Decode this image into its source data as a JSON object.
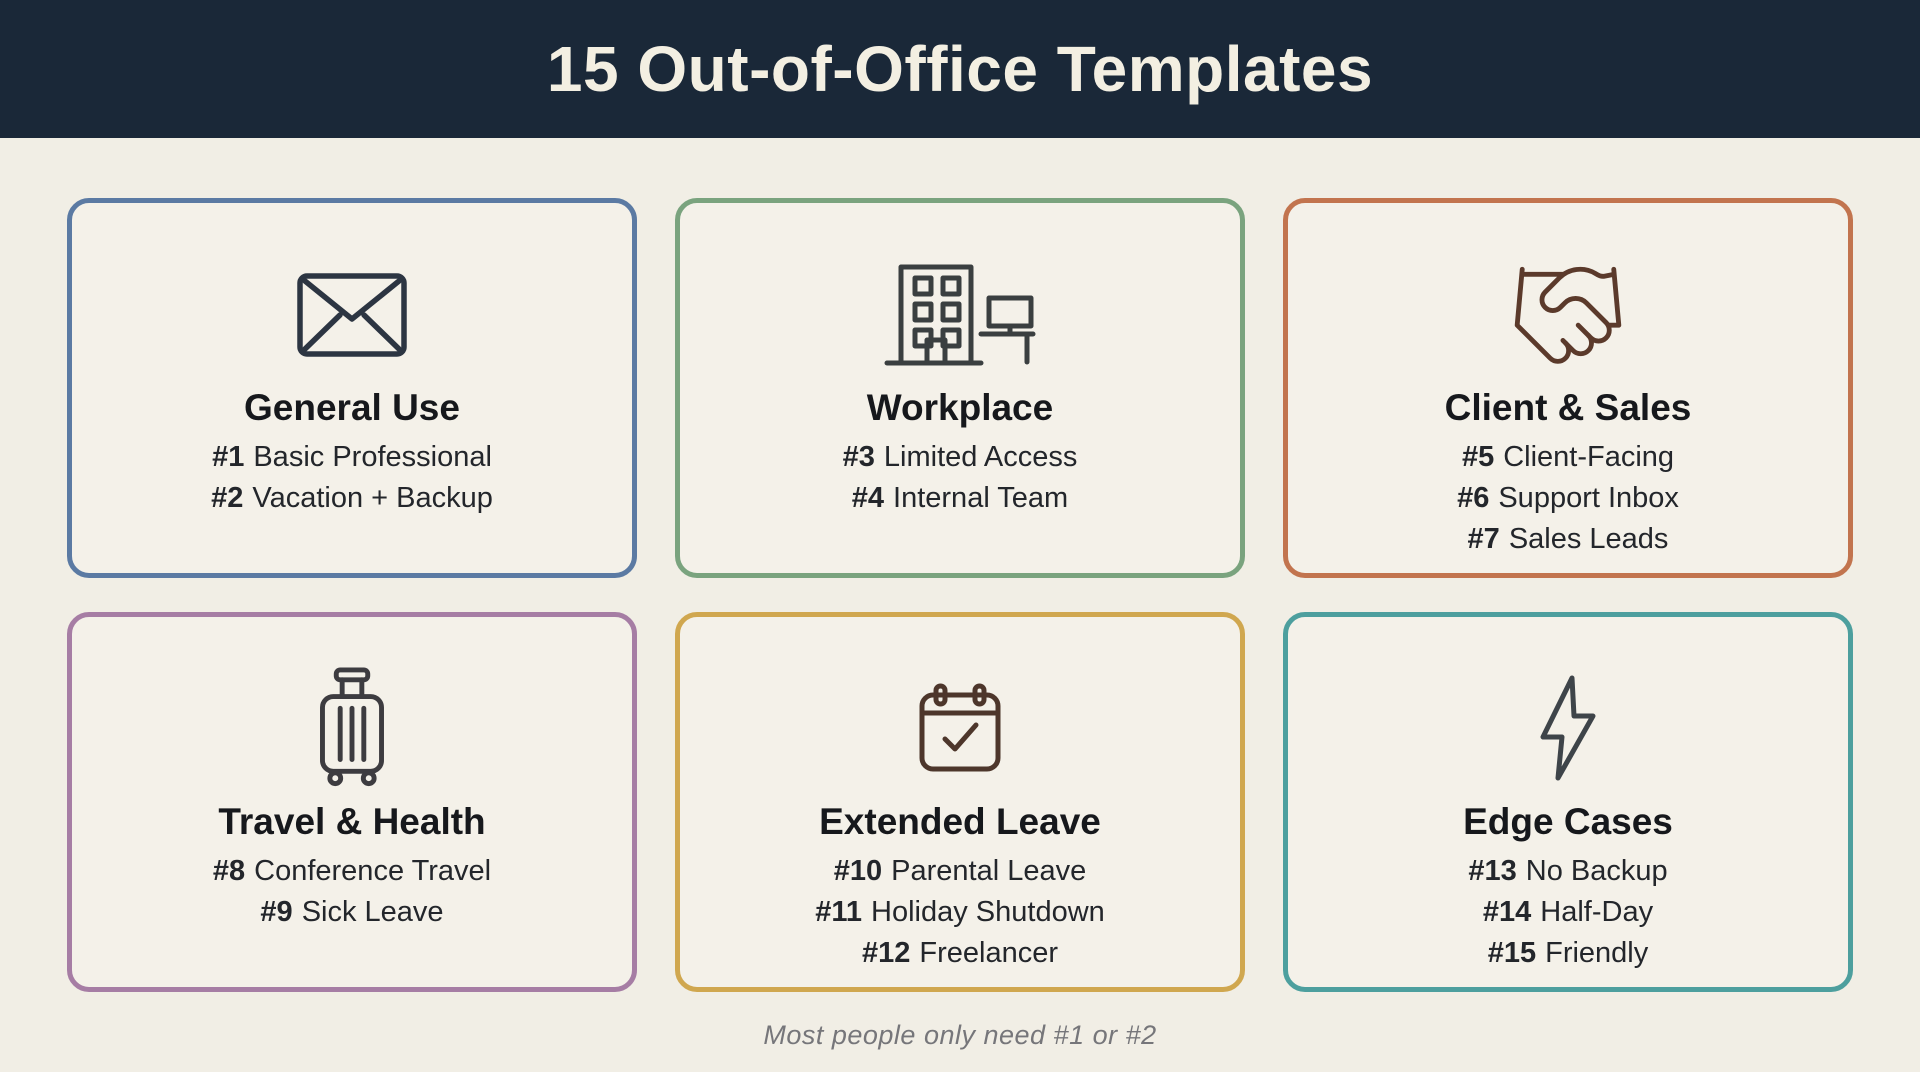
{
  "header": {
    "title": "15 Out-of-Office Templates",
    "bg_color": "#1a2838",
    "text_color": "#f3efe2"
  },
  "cards": [
    {
      "title": "General Use",
      "icon": "envelope-icon",
      "border_color": "#5b7aa3",
      "items": [
        {
          "num": "#1",
          "label": "Basic Professional"
        },
        {
          "num": "#2",
          "label": "Vacation + Backup"
        }
      ]
    },
    {
      "title": "Workplace",
      "icon": "office-building-icon",
      "border_color": "#7aa37e",
      "items": [
        {
          "num": "#3",
          "label": "Limited Access"
        },
        {
          "num": "#4",
          "label": "Internal Team"
        }
      ]
    },
    {
      "title": "Client & Sales",
      "icon": "handshake-icon",
      "border_color": "#c2744e",
      "items": [
        {
          "num": "#5",
          "label": "Client-Facing"
        },
        {
          "num": "#6",
          "label": "Support Inbox"
        },
        {
          "num": "#7",
          "label": "Sales Leads"
        }
      ]
    },
    {
      "title": "Travel & Health",
      "icon": "suitcase-icon",
      "border_color": "#a67da4",
      "items": [
        {
          "num": "#8",
          "label": "Conference Travel"
        },
        {
          "num": "#9",
          "label": "Sick Leave"
        }
      ]
    },
    {
      "title": "Extended Leave",
      "icon": "calendar-check-icon",
      "border_color": "#d0a74f",
      "items": [
        {
          "num": "#10",
          "label": "Parental Leave"
        },
        {
          "num": "#11",
          "label": "Holiday Shutdown"
        },
        {
          "num": "#12",
          "label": "Freelancer"
        }
      ]
    },
    {
      "title": "Edge Cases",
      "icon": "lightning-bolt-icon",
      "border_color": "#4d9f9e",
      "items": [
        {
          "num": "#13",
          "label": "No Backup"
        },
        {
          "num": "#14",
          "label": "Half-Day"
        },
        {
          "num": "#15",
          "label": "Friendly"
        }
      ]
    }
  ],
  "footer": {
    "note": "Most people only need #1 or #2"
  },
  "colors": {
    "page_bg": "#f1eee5",
    "card_bg": "#f4f1e9",
    "card_title_text": "#16181c",
    "item_text": "#23262b",
    "footer_text": "#76767a"
  }
}
